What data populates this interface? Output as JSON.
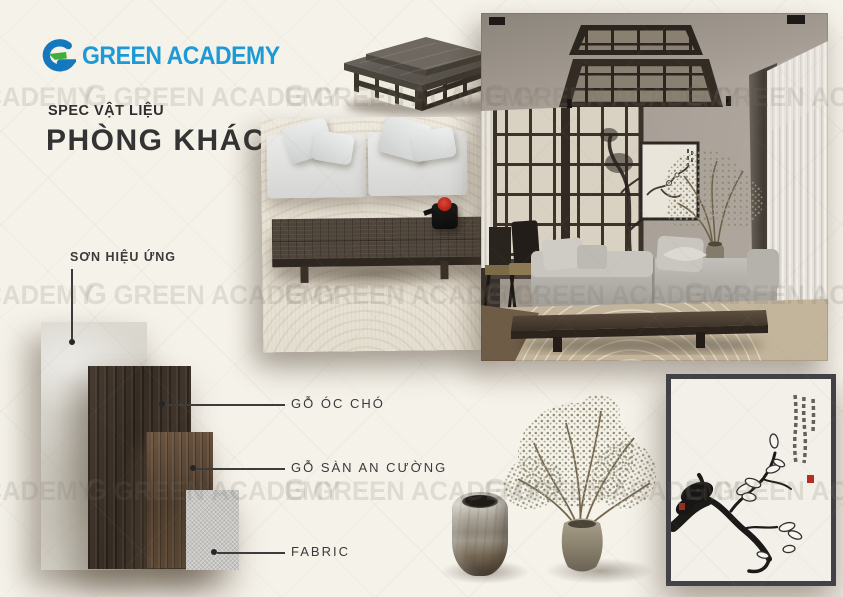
{
  "brand": {
    "logo_mark": "G",
    "logo_text": "GREEN ACADEMY"
  },
  "header": {
    "kicker": "SPEC VẬT LIỆU",
    "title": "PHÒNG KHÁCH"
  },
  "materials": {
    "items": [
      {
        "label": "SƠN HIỆU ỨNG"
      },
      {
        "label": "GỖ ÓC CHÓ"
      },
      {
        "label": "GỖ SÀN AN CƯỜNG"
      },
      {
        "label": "FABRIC"
      }
    ]
  },
  "watermark": {
    "mark": "G",
    "text": "GREEN ACADEMY"
  },
  "colors": {
    "background": "#f5f2ea",
    "brand_blue": "#1b9ad7",
    "brand_green": "#3fae3a",
    "text_dark": "#3a3a3a",
    "accent_red": "#a8251c"
  }
}
